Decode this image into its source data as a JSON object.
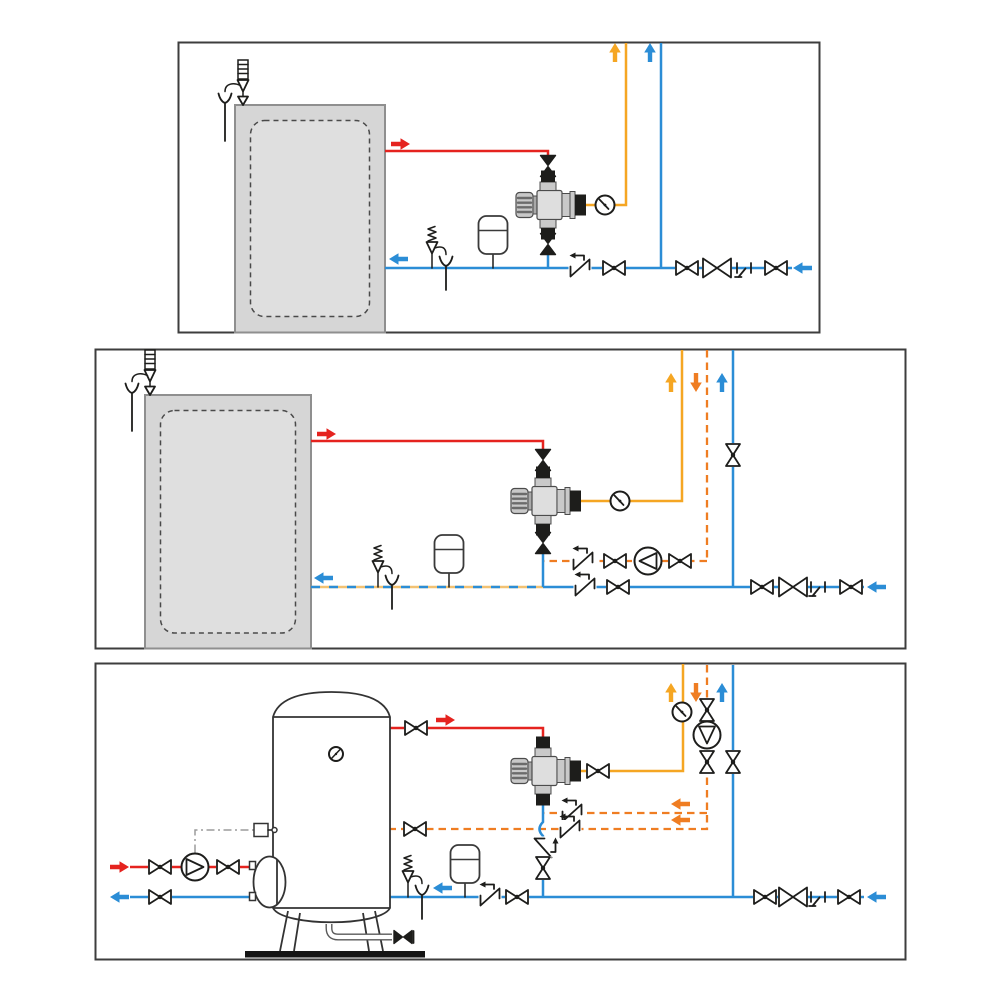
{
  "page": {
    "background": "#ffffff",
    "description": "three piping schematics for thermostatic mixing valve installations"
  },
  "colors": {
    "hot_water": "#e5231f",
    "cold_water": "#2b8dd6",
    "mixed_water": "#f5a623",
    "recirculation": "#ef7d22",
    "combined_dash_base": "#f2c273",
    "symbol_ink": "#1d1d1b",
    "panel_border": "#3d3d3d",
    "heater_fill": "#d6d6d6",
    "heater_inner_fill": "#dfdfdf",
    "heater_border": "#8f8f8f",
    "tank_stroke": "#333333",
    "metal_light": "#c9c9c9",
    "metal_mid": "#a9a9a9",
    "control_line": "#9b9b9b",
    "base_bar": "#151515"
  },
  "legend": {
    "solid_red": "hot water",
    "solid_blue": "cold water",
    "solid_orange": "mixed water",
    "dashed_orange": "recirculation return",
    "blue_orange_dashed": "cold water plus recirculation return"
  },
  "panels": [
    {
      "id": "panel-1",
      "equipment": "wall-hung storage water heater",
      "components": [
        "temperature-relief-valve-with-tundish",
        "shutoff-valve-hot",
        "thermostatic-mixing-valve",
        "temperature-gauge",
        "shutoff-valve-cold-feed",
        "safety-relief-valve-with-tundish",
        "expansion-vessel",
        "check-valve",
        "ball-valve",
        "ball-valve",
        "main-shutoff-valve",
        "drain-cock",
        "ball-valve"
      ],
      "arrows": [
        {
          "name": "hot-outlet",
          "color": "hot_water",
          "direction": "right"
        },
        {
          "name": "mixed-riser",
          "color": "mixed_water",
          "direction": "up"
        },
        {
          "name": "cold-riser",
          "color": "cold_water",
          "direction": "up"
        },
        {
          "name": "cold-to-heater",
          "color": "cold_water",
          "direction": "left"
        },
        {
          "name": "cold-inlet",
          "color": "cold_water",
          "direction": "left"
        }
      ]
    },
    {
      "id": "panel-2",
      "equipment": "wall-hung storage water heater with recirculation loop",
      "components": [
        "temperature-relief-valve-with-tundish",
        "shutoff-valve-hot",
        "thermostatic-mixing-valve",
        "temperature-gauge",
        "shutoff-valve-cold-feed",
        "check-valve-recirc",
        "ball-valve-recirc",
        "recirculation-pump",
        "ball-valve-recirc",
        "riser-shutoff-valve",
        "safety-relief-valve-with-tundish",
        "expansion-vessel",
        "check-valve",
        "ball-valve",
        "ball-valve",
        "main-shutoff-valve",
        "drain-cock",
        "ball-valve"
      ],
      "arrows": [
        {
          "name": "hot-outlet",
          "color": "hot_water",
          "direction": "right"
        },
        {
          "name": "mixed-riser",
          "color": "mixed_water",
          "direction": "up"
        },
        {
          "name": "recirc-riser",
          "color": "recirculation",
          "direction": "down"
        },
        {
          "name": "cold-riser",
          "color": "cold_water",
          "direction": "up"
        },
        {
          "name": "combined-to-heater",
          "color": "cold_water",
          "direction": "left"
        },
        {
          "name": "cold-inlet",
          "color": "cold_water",
          "direction": "left"
        }
      ]
    },
    {
      "id": "panel-3",
      "equipment": "floor-standing storage tank with primary circuit and dual recirculation branches",
      "components": [
        "thermometer",
        "manway-flange",
        "aquastat-sensor",
        "control-line",
        "primary-pump",
        "ball-valve-primary",
        "ball-valve-primary",
        "ball-valve-return",
        "tank-drain-valve",
        "shutoff-valve-hot",
        "thermostatic-mixing-valve",
        "shutoff-valve-mixed",
        "temperature-gauge",
        "riser-shutoff-valve",
        "recirculation-pump",
        "riser-shutoff-valve",
        "riser-shutoff-valve-cold",
        "check-valve-recirc-upper",
        "check-valve-recirc-lower",
        "ball-valve-recirc-tank",
        "check-valve-cold-feed",
        "shutoff-valve-cold-feed",
        "safety-relief-valve-with-tundish",
        "expansion-vessel",
        "check-valve",
        "ball-valve",
        "ball-valve",
        "main-shutoff-valve",
        "drain-cock",
        "ball-valve"
      ],
      "arrows": [
        {
          "name": "primary-supply",
          "color": "hot_water",
          "direction": "right"
        },
        {
          "name": "primary-return",
          "color": "cold_water",
          "direction": "left"
        },
        {
          "name": "hot-outlet",
          "color": "hot_water",
          "direction": "right"
        },
        {
          "name": "mixed-riser",
          "color": "mixed_water",
          "direction": "up"
        },
        {
          "name": "recirc-riser",
          "color": "recirculation",
          "direction": "down"
        },
        {
          "name": "cold-riser",
          "color": "cold_water",
          "direction": "up"
        },
        {
          "name": "recirc-to-mixer",
          "color": "recirculation",
          "direction": "left"
        },
        {
          "name": "recirc-to-tank",
          "color": "recirculation",
          "direction": "left"
        },
        {
          "name": "cold-to-tank",
          "color": "cold_water",
          "direction": "left"
        },
        {
          "name": "cold-inlet",
          "color": "cold_water",
          "direction": "left"
        }
      ]
    }
  ]
}
